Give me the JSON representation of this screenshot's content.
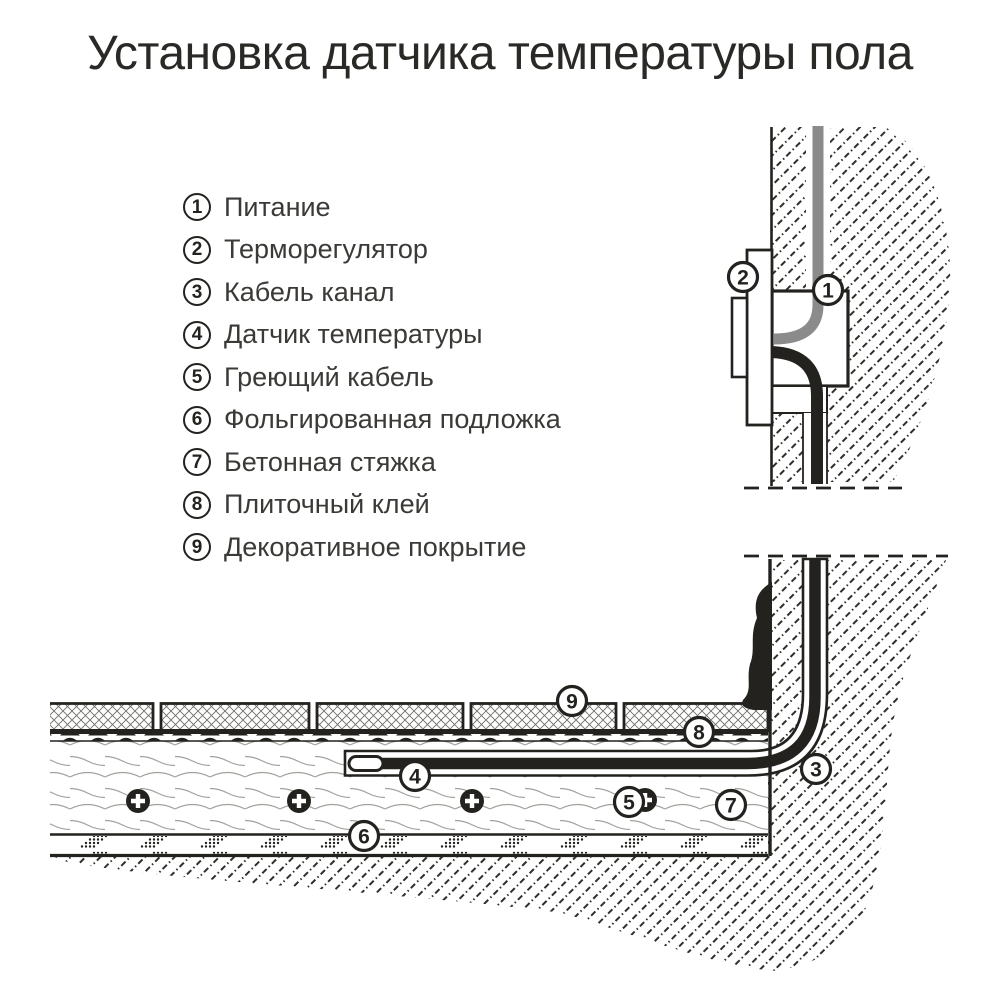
{
  "title": "Установка датчика температуры пола",
  "legend": {
    "items": [
      {
        "number": "1",
        "label": "Питание"
      },
      {
        "number": "2",
        "label": "Терморегулятор"
      },
      {
        "number": "3",
        "label": "Кабель канал"
      },
      {
        "number": "4",
        "label": "Датчик температуры"
      },
      {
        "number": "5",
        "label": "Греющий кабель"
      },
      {
        "number": "6",
        "label": "Фольгированная подложка"
      },
      {
        "number": "7",
        "label": "Бетонная стяжка"
      },
      {
        "number": "8",
        "label": "Плиточный клей"
      },
      {
        "number": "9",
        "label": "Декоративное покрытие"
      }
    ]
  },
  "diagram": {
    "callouts": {
      "power": "1",
      "thermostat": "2",
      "cable_channel": "3",
      "temperature_sensor": "4",
      "heating_cable": "5",
      "foil_underlay": "6",
      "concrete_screed": "7",
      "tile_adhesive": "8",
      "decorative_cover": "9"
    }
  },
  "colors": {
    "ink": "#23221e",
    "cable_gray": "#8b8b8b",
    "background": "#ffffff"
  }
}
